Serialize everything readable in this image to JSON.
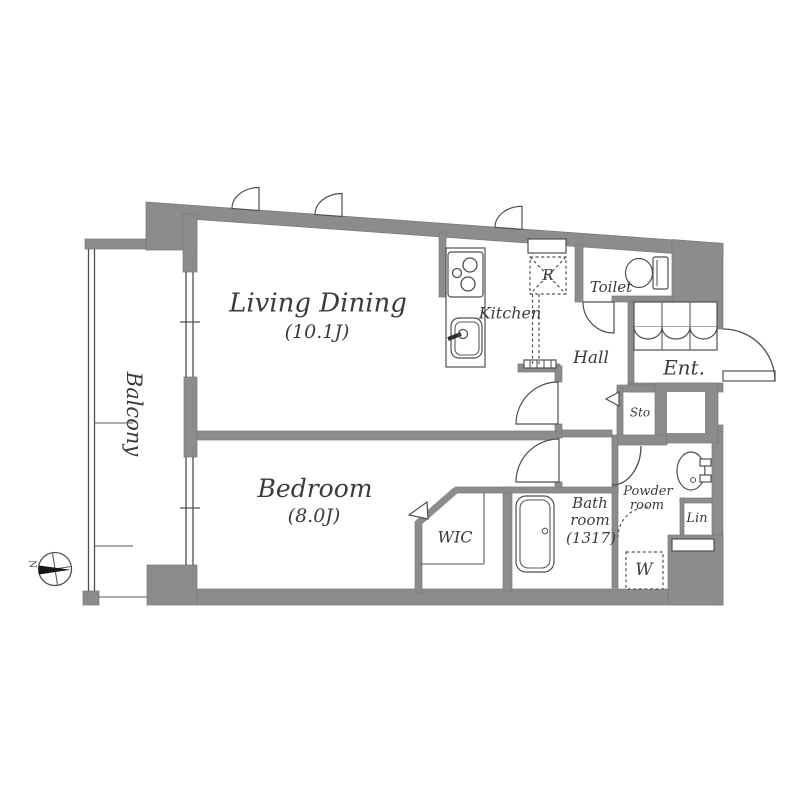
{
  "meta": {
    "type": "apartment-floor-plan"
  },
  "colors": {
    "wall": "#8b8c8e",
    "line": "#4f4f53",
    "text": "#3b3b3d",
    "background": "#ffffff"
  },
  "rooms": {
    "living_dining": {
      "name": "Living Dining",
      "area": "(10.1J)"
    },
    "bedroom": {
      "name": "Bedroom",
      "area": "(8.0J)"
    },
    "balcony": {
      "name": "Balcony"
    },
    "kitchen": {
      "name": "Kitchen"
    },
    "hall": {
      "name": "Hall"
    },
    "toilet": {
      "name": "Toilet"
    },
    "entrance": {
      "name": "Ent."
    },
    "storage": {
      "name": "Sto"
    },
    "wic": {
      "name": "WIC"
    },
    "bathroom": {
      "line1": "Bath",
      "line2": "room",
      "line3": "(1317)"
    },
    "powder_room": {
      "line1": "Powder",
      "line2": "room"
    },
    "linen": {
      "name": "Lin"
    }
  },
  "fixtures": {
    "refrigerator": "R",
    "washing_machine": "W"
  },
  "compass": {
    "north": "N"
  }
}
